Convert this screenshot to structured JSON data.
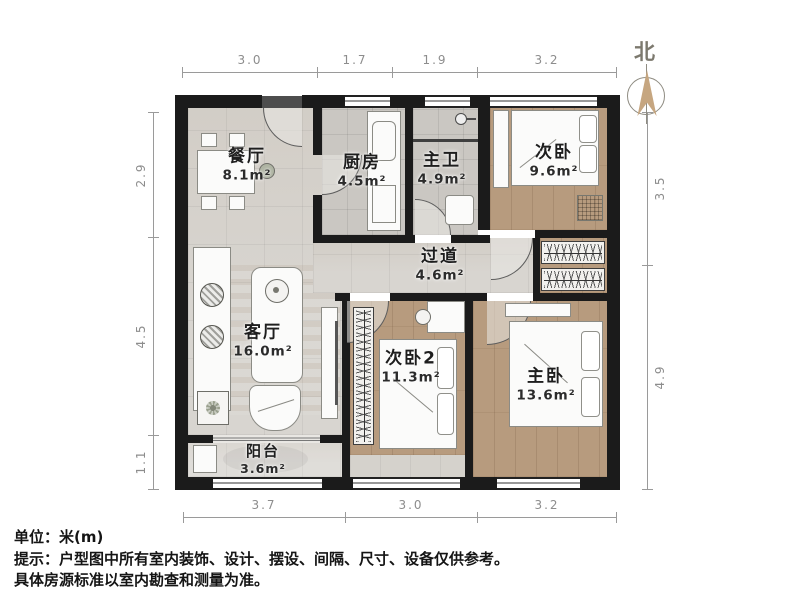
{
  "north": {
    "label": "北"
  },
  "rooms": {
    "dining": {
      "name": "餐厅",
      "area": "8.1m²"
    },
    "kitchen": {
      "name": "厨房",
      "area": "4.5m²"
    },
    "master_bath": {
      "name": "主卫",
      "area": "4.9m²"
    },
    "bedroom2": {
      "name": "次卧",
      "area": "9.6m²"
    },
    "hallway": {
      "name": "过道",
      "area": "4.6m²"
    },
    "living": {
      "name": "客厅",
      "area": "16.0m²"
    },
    "bedroom3": {
      "name": "次卧2",
      "area": "11.3m²"
    },
    "master_bedroom": {
      "name": "主卧",
      "area": "13.6m²"
    },
    "balcony": {
      "name": "阳台",
      "area": "3.6m²"
    }
  },
  "dimensions": {
    "top": [
      "3.0",
      "1.7",
      "1.9",
      "3.2"
    ],
    "bottom": [
      "3.7",
      "3.0",
      "3.2"
    ],
    "left": [
      "2.9",
      "4.5",
      "1.1"
    ],
    "right": [
      "3.5",
      "4.9"
    ]
  },
  "notes": {
    "unit": "单位：米(m)",
    "tip": "提示：户型图中所有室内装饰、设计、摆设、间隔、尺寸、设备仅供参考。",
    "standard": "具体房源标准以室内勘查和测量为准。"
  },
  "colors": {
    "wall": "#1b1b1b",
    "wood_floor": "#b79b7e",
    "marble_floor": "#d8d5d0",
    "tile_floor": "#cac7c2",
    "north_arrow": "#c6a680",
    "dimension_line": "#9a9a9a"
  }
}
